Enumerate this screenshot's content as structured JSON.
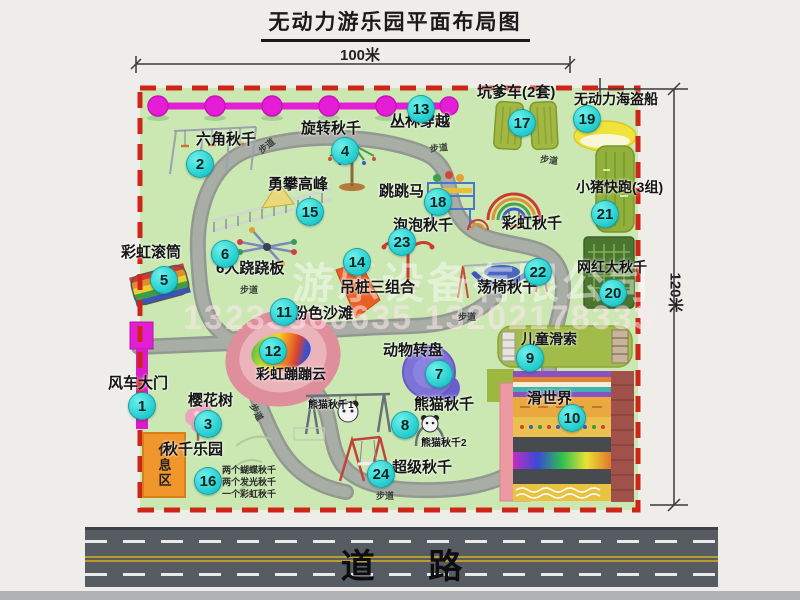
{
  "title": "无动力游乐园平面布局图",
  "dimensions": {
    "width": "100米",
    "height": "120米"
  },
  "road": {
    "label": "道 路"
  },
  "watermark": {
    "line1": "游乐设备有限公司",
    "line2": "13233860635 13202178333"
  },
  "rest_area": {
    "label": "休息区"
  },
  "colors": {
    "map_green": "#cbe8b3",
    "boundary_red": "#cf2518",
    "marker_cyan": "#33d6d6",
    "zipline_magenta": "#e61dd6",
    "path_gray": "#a5aaa3",
    "road_gray": "#575c63"
  },
  "map": {
    "markers": [
      {
        "num": "1",
        "x": 141,
        "y": 405
      },
      {
        "num": "2",
        "x": 199,
        "y": 163
      },
      {
        "num": "3",
        "x": 207,
        "y": 423
      },
      {
        "num": "4",
        "x": 344,
        "y": 150
      },
      {
        "num": "5",
        "x": 163,
        "y": 279
      },
      {
        "num": "6",
        "x": 224,
        "y": 253
      },
      {
        "num": "7",
        "x": 438,
        "y": 373
      },
      {
        "num": "8",
        "x": 404,
        "y": 424
      },
      {
        "num": "9",
        "x": 529,
        "y": 357
      },
      {
        "num": "10",
        "x": 571,
        "y": 417
      },
      {
        "num": "11",
        "x": 283,
        "y": 311
      },
      {
        "num": "12",
        "x": 272,
        "y": 350
      },
      {
        "num": "13",
        "x": 420,
        "y": 108
      },
      {
        "num": "14",
        "x": 356,
        "y": 261
      },
      {
        "num": "15",
        "x": 309,
        "y": 211
      },
      {
        "num": "16",
        "x": 207,
        "y": 480
      },
      {
        "num": "17",
        "x": 521,
        "y": 122
      },
      {
        "num": "18",
        "x": 437,
        "y": 201
      },
      {
        "num": "19",
        "x": 586,
        "y": 118
      },
      {
        "num": "20",
        "x": 612,
        "y": 292
      },
      {
        "num": "21",
        "x": 604,
        "y": 213
      },
      {
        "num": "22",
        "x": 537,
        "y": 271
      },
      {
        "num": "23",
        "x": 401,
        "y": 241
      },
      {
        "num": "24",
        "x": 380,
        "y": 473
      }
    ],
    "labels": [
      {
        "text": "六角秋千",
        "x": 196,
        "y": 132
      },
      {
        "text": "旋转秋千",
        "x": 301,
        "y": 121
      },
      {
        "text": "丛林穿越",
        "x": 390,
        "y": 114
      },
      {
        "text": "坑爹车(2套)",
        "x": 477,
        "y": 85
      },
      {
        "text": "无动力海盗船",
        "x": 574,
        "y": 92,
        "size": 14
      },
      {
        "text": "勇攀高峰",
        "x": 268,
        "y": 177
      },
      {
        "text": "跳跳马",
        "x": 379,
        "y": 184
      },
      {
        "text": "泡泡秋千",
        "x": 393,
        "y": 218
      },
      {
        "text": "彩虹秋千",
        "x": 502,
        "y": 216
      },
      {
        "text": "小猪快跑(3组)",
        "x": 576,
        "y": 180,
        "size": 14
      },
      {
        "text": "彩虹滚筒",
        "x": 121,
        "y": 245
      },
      {
        "text": "6人跷跷板",
        "x": 216,
        "y": 261
      },
      {
        "text": "吊桩三组合",
        "x": 340,
        "y": 280
      },
      {
        "text": "荡椅秋千",
        "x": 477,
        "y": 280
      },
      {
        "text": "网红大秋千",
        "x": 577,
        "y": 260,
        "size": 14
      },
      {
        "text": "粉色沙滩",
        "x": 293,
        "y": 306
      },
      {
        "text": "动物转盘",
        "x": 383,
        "y": 343
      },
      {
        "text": "彩虹蹦蹦云",
        "x": 256,
        "y": 367,
        "size": 14
      },
      {
        "text": "儿童滑索",
        "x": 521,
        "y": 332,
        "size": 14
      },
      {
        "text": "滑世界",
        "x": 527,
        "y": 391
      },
      {
        "text": "风车大门",
        "x": 108,
        "y": 376
      },
      {
        "text": "樱花树",
        "x": 188,
        "y": 393
      },
      {
        "text": "熊猫秋千",
        "x": 414,
        "y": 397
      },
      {
        "text": "熊猫秋千1",
        "x": 308,
        "y": 401,
        "size": 10
      },
      {
        "text": "熊猫秋千2",
        "x": 421,
        "y": 439,
        "size": 10
      },
      {
        "text": "超级秋千",
        "x": 392,
        "y": 460
      },
      {
        "text": "秋千乐园",
        "x": 163,
        "y": 442
      }
    ],
    "trail_label": "步道",
    "trail_positions": [
      {
        "x": 258,
        "y": 142,
        "rot": -38
      },
      {
        "x": 430,
        "y": 144,
        "rot": -6
      },
      {
        "x": 540,
        "y": 156,
        "rot": 8
      },
      {
        "x": 240,
        "y": 286,
        "rot": 0
      },
      {
        "x": 458,
        "y": 313,
        "rot": 0
      },
      {
        "x": 247,
        "y": 408,
        "rot": 62
      },
      {
        "x": 376,
        "y": 492,
        "rot": 0
      }
    ],
    "swing_park_notes": [
      {
        "text": "两个蝴蝶秋千",
        "x": 222,
        "y": 466
      },
      {
        "text": "两个发光秋千",
        "x": 222,
        "y": 478
      },
      {
        "text": "一个彩虹秋千",
        "x": 222,
        "y": 490
      }
    ]
  }
}
